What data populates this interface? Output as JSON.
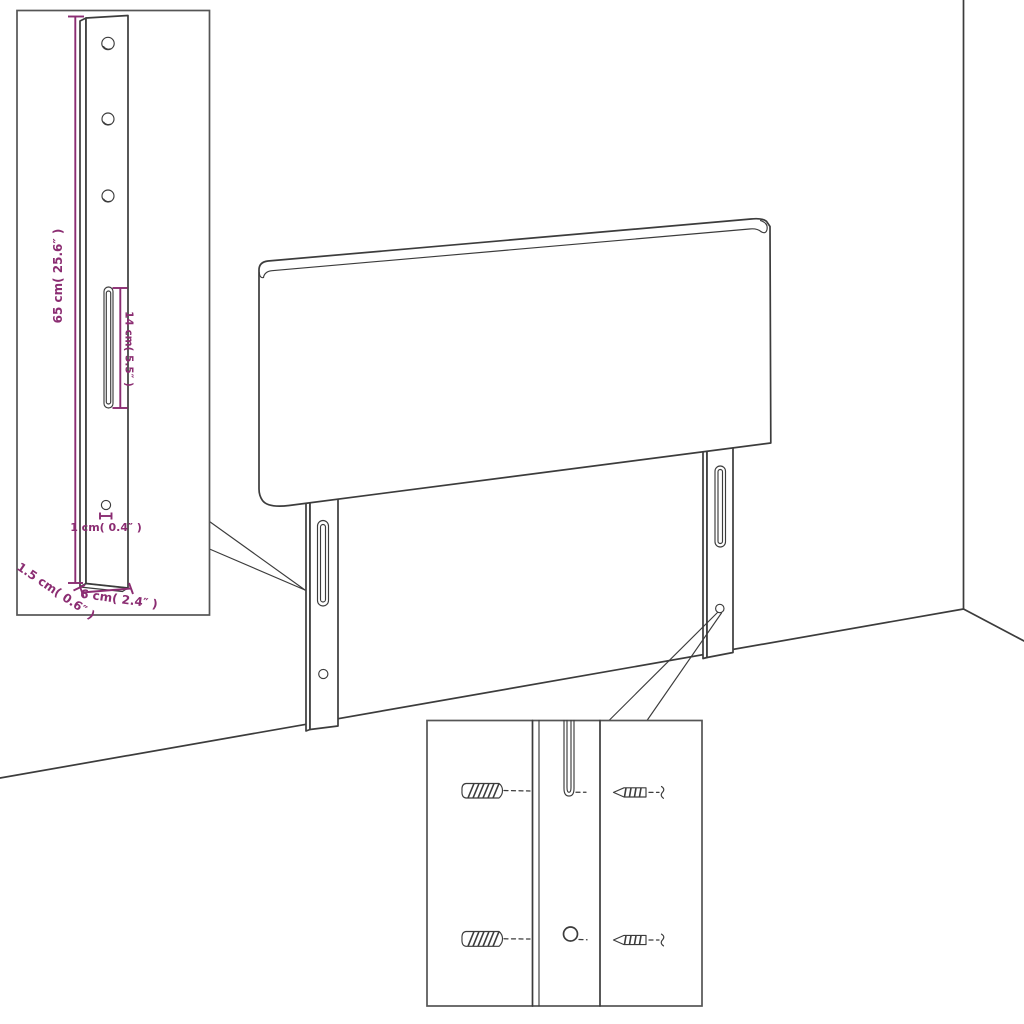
{
  "diagram": {
    "dimension_labels": {
      "leg_height": "65 cm( 25.6″ )",
      "slot_length": "14 cm( 5.5″ )",
      "hole_diameter": "1 cm( 0.4″ )",
      "leg_thickness": "1.5 cm( 0.6″ )",
      "leg_width": "6 cm( 2.4″ )"
    },
    "icons": {
      "wall_plug": "wall-plug-icon",
      "screw": "screw-icon"
    }
  },
  "colors": {
    "line": "#3c3c3c",
    "dimension": "#8b2d72",
    "border": "#555555",
    "background": "#ffffff"
  }
}
